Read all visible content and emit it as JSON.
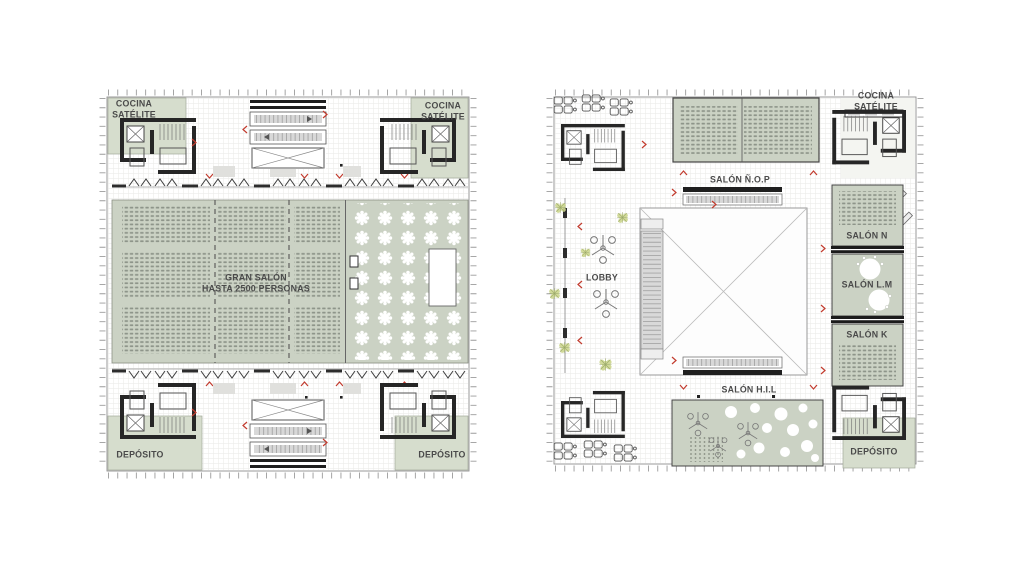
{
  "colors": {
    "hall_green": "#cbd2c4",
    "corner_room_green": "#d6ddcd",
    "wall_black": "#262626",
    "marker_red": "#c23b2e",
    "grid_line": "#ececea",
    "seat_gray": "#8e958a"
  },
  "left_plan": {
    "labels": {
      "cocina_top_left": "COCINA\nSATÉLITE",
      "cocina_top_right": "COCINA\nSATÉLITE",
      "gran_salon": "GRAN SALÓN\nHASTA 2500 PERSONAS",
      "deposito_bottom_left": "DEPÓSITO",
      "deposito_bottom_right": "DEPÓSITO"
    }
  },
  "right_plan": {
    "labels": {
      "salon_nop": "SALÓN Ñ.O.P",
      "cocina_satelite": "COCINA SATÉLITE",
      "lobby": "LOBBY",
      "salon_n": "SALÓN N",
      "salon_lm": "SALÓN L.M",
      "salon_k": "SALÓN K",
      "salon_hil": "SALÓN H.I.L",
      "deposito": "DEPÓSITO"
    }
  }
}
